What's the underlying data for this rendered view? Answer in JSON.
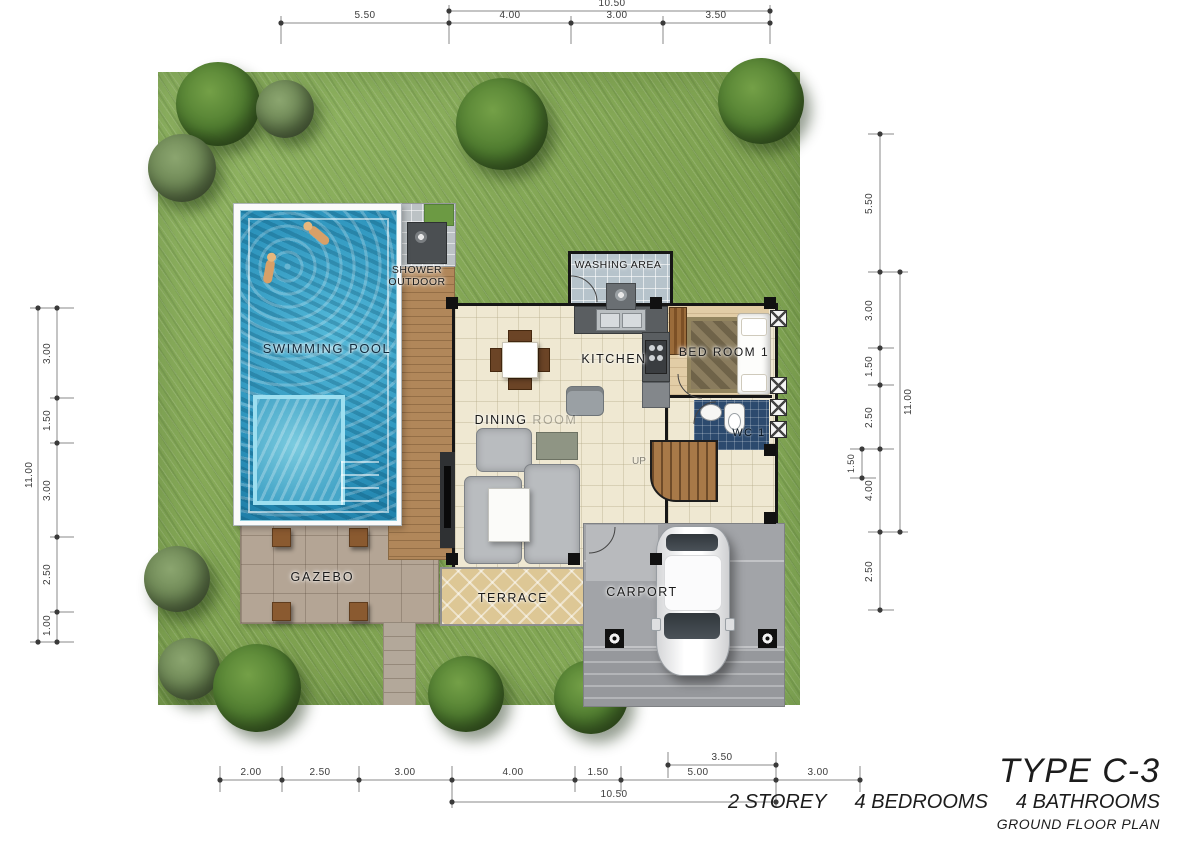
{
  "plan": {
    "title": "TYPE C-3",
    "specs": [
      "2 STOREY",
      "4 BEDROOMS",
      "4 BATHROOMS"
    ],
    "subtitle": "GROUND FLOOR PLAN"
  },
  "rooms": {
    "swimming_pool": "SWIMMING POOL",
    "shower_outdoor_line1": "SHOWER",
    "shower_outdoor_line2": "OUTDOOR",
    "washing_area": "WASHING AREA",
    "kitchen": "KITCHEN",
    "bed_room_1": "BED ROOM 1",
    "wc_1": "WC 1",
    "dining": "DINING",
    "dining_faded": "ROOM",
    "up": "UP",
    "gazebo": "GAZEBO",
    "terrace": "TERRACE",
    "carport": "CARPORT"
  },
  "dimensions": {
    "top": {
      "total": "10.50",
      "segments": [
        "5.50",
        "4.00",
        "3.00",
        "3.50"
      ]
    },
    "bottom": {
      "total": "10.50",
      "carport_width": "3.50",
      "segments": [
        "2.00",
        "2.50",
        "3.00",
        "4.00",
        "1.50",
        "5.00",
        "3.00"
      ]
    },
    "left": {
      "total": "11.00",
      "segments": [
        "3.00",
        "1.50",
        "3.00",
        "2.50",
        "1.00"
      ]
    },
    "right": {
      "total": "11.00",
      "porch_depth": "1.50",
      "segments": [
        "5.50",
        "3.00",
        "1.50",
        "2.50",
        "4.00",
        "2.50"
      ]
    }
  },
  "colors": {
    "grass": "#85aa57",
    "tree": "#4d7a2e",
    "pool_water": "#2b92bb",
    "deck_wood": "#b1875a",
    "house_floor": "#efe8d2",
    "bedroom_floor": "#e2cda6",
    "wc_tile": "#2c4a6e",
    "terrace": "#ddc795",
    "carport": "#a2a4a8",
    "wall": "#161616"
  }
}
